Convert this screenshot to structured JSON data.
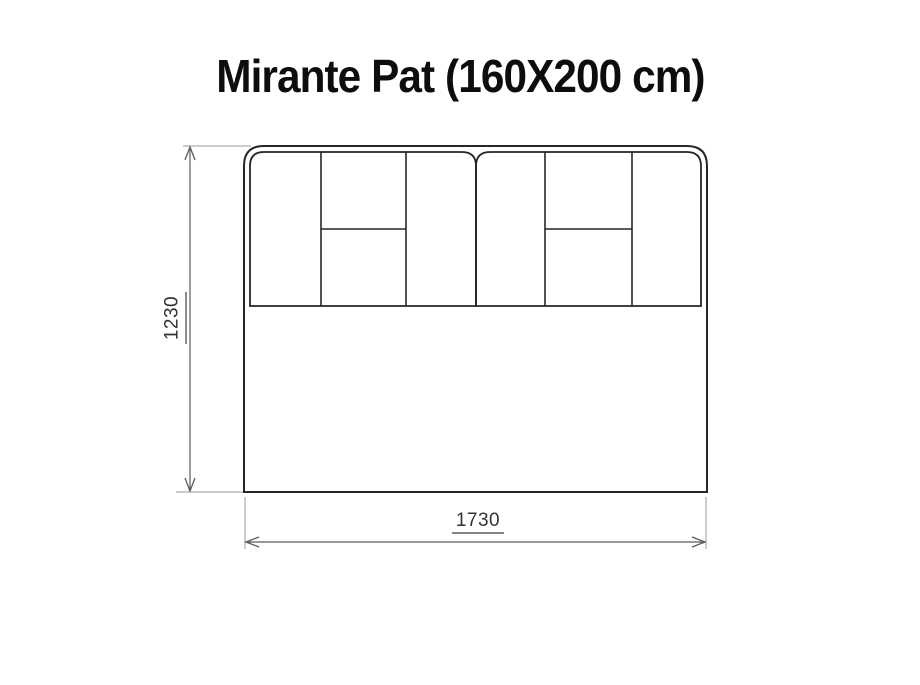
{
  "title": "Mirante Pat (160X200 cm)",
  "dimensions": {
    "height_label": "1230",
    "width_label": "1730"
  },
  "colors": {
    "background": "#ffffff",
    "outline": "#262626",
    "panel_line": "#262626",
    "dimension_line": "#5a5a5a",
    "extension_line": "#9a9a9a",
    "title_text": "#0d0d0d"
  }
}
